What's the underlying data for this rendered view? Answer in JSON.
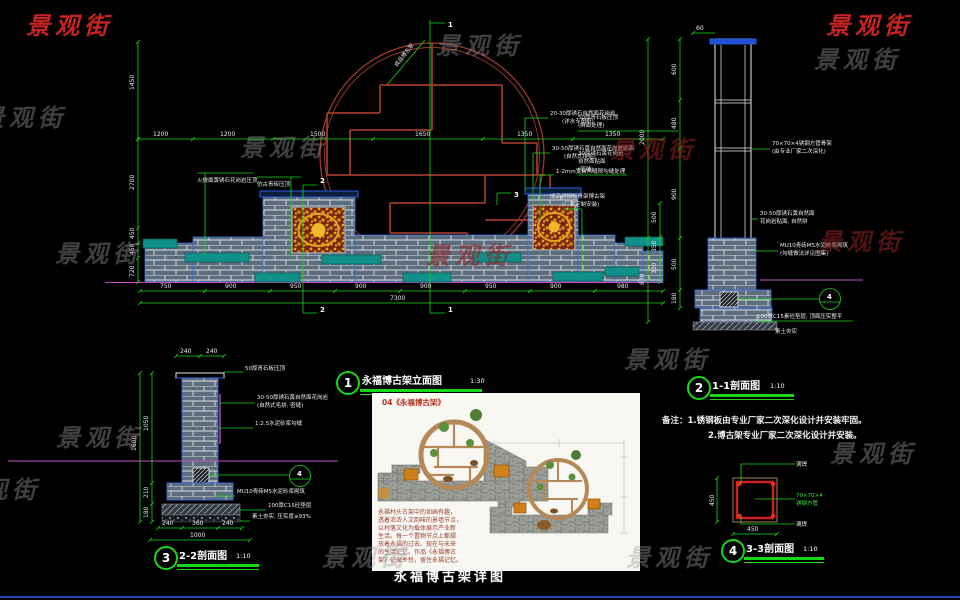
{
  "watermark": {
    "text": "景观街"
  },
  "sheet": {
    "title": "永福博古架详图"
  },
  "labels": {
    "v1": {
      "num": "1",
      "title": "永福博古架立面图",
      "scale": "1:30"
    },
    "v2": {
      "num": "2",
      "title": "1-1剖面图",
      "scale": "1:10"
    },
    "v3": {
      "num": "3",
      "title": "2-2剖面图",
      "scale": "1:10"
    },
    "v4": {
      "num": "4",
      "title": "3-3剖面图",
      "scale": "1:10"
    }
  },
  "notes": {
    "line1": "备注：1.锈钢板由专业厂家二次深化设计并安装牢固。",
    "line2": "2.博古架专业厂家二次深化设计并安装。"
  },
  "photo": {
    "caption": "04《永福博古架》",
    "desc": [
      "永福村头古架中的如画有趣，",
      "透着浓浓人文韵味的景墙节点，",
      "以村落文化为载体展示产业新",
      "生活。每一个置物节点上都摆",
      "放着永福的过去、现在与未来",
      "的生活记忆。作品《永福博古",
      "架》记录乡愁，留住永福记忆。"
    ]
  },
  "elev": {
    "dims_top": [
      "1200",
      "1200",
      "1500",
      "1650",
      "1350",
      "1350"
    ],
    "dims_left": [
      "1450",
      "2700",
      "450",
      "450",
      "720"
    ],
    "dims_right": [
      "500",
      "350",
      "330"
    ],
    "dims_bottom": [
      "750",
      "900",
      "950",
      "900",
      "900",
      "950",
      "900",
      "980"
    ],
    "dim_total": "7300",
    "ann_l1": "火烧面黄锈石花岗岩压顶",
    "ann_l2": "仿古青砖压顶",
    "ann_r1a": "20-30厚锈石自然面花岗岩",
    "ann_r1b": "(详水专图纸)",
    "ann_r2a": "30-50厚锈石黄自然面花岗岩贴面",
    "ann_r2b": "(自然式拼贴)",
    "ann_r3": "1-2mm宽自然缝隙勾缝处理",
    "ann_r4a": "成品锈钢板骨架博古架",
    "ann_r4b": "(厂家定制安装)",
    "diag": "成品博古架",
    "cut_t1": "1",
    "cut_b1": "1",
    "cut_t2": "2",
    "cut_b2": "2",
    "cut_3": "3"
  },
  "sec1": {
    "dim_top": "60",
    "dims_left_in": [
      "600",
      "480",
      "900",
      "500",
      "180"
    ],
    "dims_left_out": [
      "2000",
      "830"
    ],
    "ann_l1a": "50厚青石板压顶",
    "ann_l1b": "(麻面处理)",
    "ann_l2a": "30厚锈石黄花岗岩",
    "ann_l2b": "自然面贴面",
    "ann_l2c": "(密缝)",
    "ann_r1a": "70×70×4锈钢方管骨架",
    "ann_r1b": "(由专业厂家二次深化)",
    "ann_r2a": "30-50厚锈石黄自然面",
    "ann_r2b": "花岗岩贴面, 自然拼",
    "ann_r3a": "MU10青砖M5水泥砂浆砌筑",
    "ann_r3b": "(勾缝做法详见图集)",
    "ann_r4": "100厚C15素砼垫层, 顶面压实整平",
    "ann_r5": "素土夯实",
    "detail_num": "4"
  },
  "sec2": {
    "dims_top": [
      "240",
      "240"
    ],
    "dims_left": [
      "1050",
      "210",
      "180"
    ],
    "dim_left_total": "1600",
    "dims_bottom": [
      "240",
      "360",
      "240"
    ],
    "dim_bottom_total": "1000",
    "ann_r1": "50厚青石板压顶",
    "ann_r2a": "30-50厚锈石黄自然面花岗岩",
    "ann_r2b": "(自然式毛拼, 密缝)",
    "ann_r3": "1:2.5水泥砂浆勾缝",
    "ann_r4": "MU10青砖M5水泥砂浆砌筑",
    "ann_r5": "100厚C15砼垫层",
    "ann_r6": "素土夯实, 压实度≥93%",
    "detail_num": "4"
  },
  "det": {
    "ann_top": "满焊",
    "ann_m1": "70×70×4",
    "ann_m2": "锈钢方管",
    "ann_bot": "满焊",
    "dim_left": "450",
    "dim_bottom": "450"
  }
}
